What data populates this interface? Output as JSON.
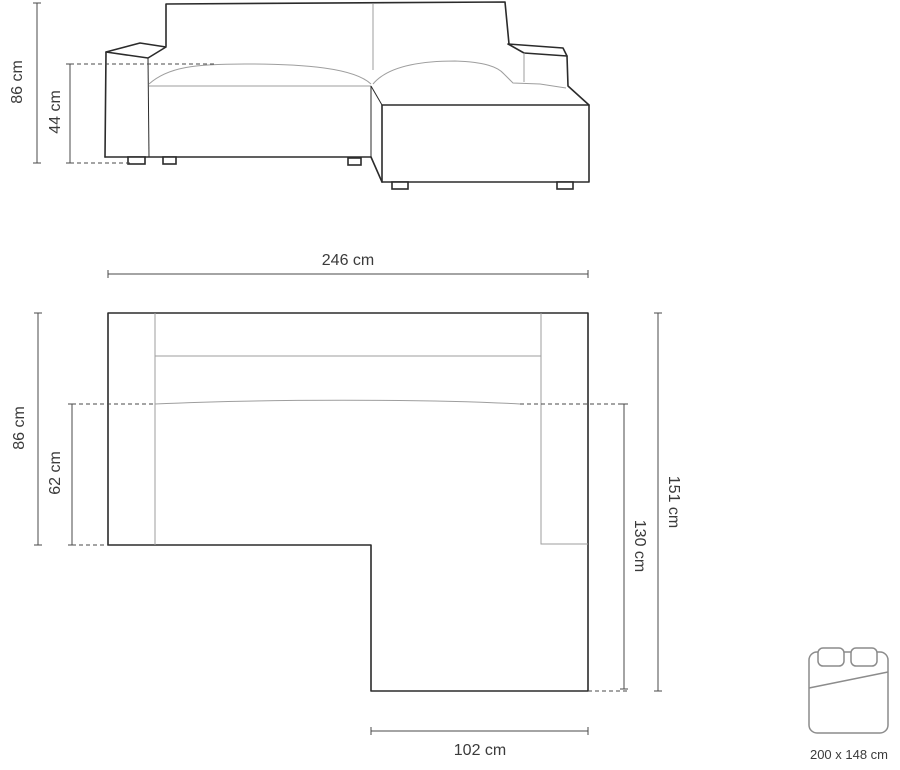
{
  "diagram_title": "corner-sofa-dimension-diagram",
  "front_view": {
    "height_label": "86 cm",
    "seat_height_label": "44 cm"
  },
  "top_view": {
    "width_label": "246 cm",
    "depth_label": "86 cm",
    "seat_depth_label": "62 cm",
    "total_side_label": "151 cm",
    "chaise_length_label": "130 cm",
    "chaise_width_label": "102 cm"
  },
  "bed_function": {
    "icon": "bed-icon",
    "size_label": "200 x 148 cm"
  },
  "colors": {
    "outline": "#2b2b2b",
    "seam": "#9e9e9e",
    "dim": "#4a4a4a",
    "text": "#3b3b3b",
    "icon": "#8c8c8c",
    "bg": "#ffffff"
  }
}
